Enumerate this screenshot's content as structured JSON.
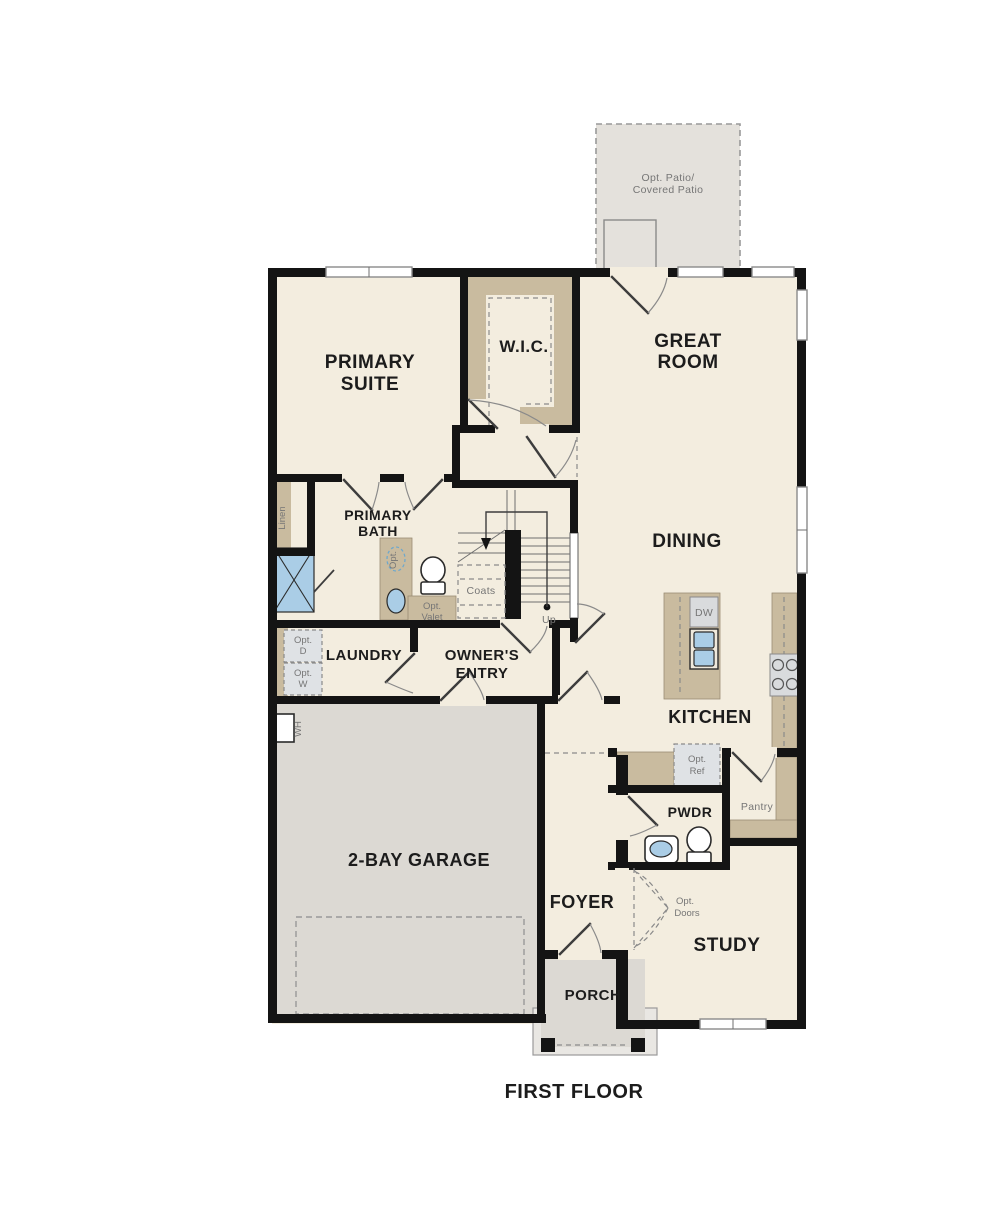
{
  "meta": {
    "title": "FIRST FLOOR",
    "plan_type": "single-family first floor plan"
  },
  "rooms": {
    "primary_suite": {
      "label_line1": "PRIMARY",
      "label_line2": "SUITE"
    },
    "wic": {
      "label": "W.I.C."
    },
    "great_room": {
      "label_line1": "GREAT",
      "label_line2": "ROOM"
    },
    "dining": {
      "label": "DINING"
    },
    "primary_bath": {
      "label_line1": "PRIMARY",
      "label_line2": "BATH"
    },
    "laundry": {
      "label": "LAUNDRY"
    },
    "owners_entry": {
      "label_line1": "OWNER'S",
      "label_line2": "ENTRY"
    },
    "kitchen": {
      "label": "KITCHEN"
    },
    "garage": {
      "label": "2-BAY GARAGE"
    },
    "pwdr": {
      "label": "PWDR"
    },
    "pantry": {
      "label": "Pantry"
    },
    "foyer": {
      "label": "FOYER"
    },
    "study": {
      "label": "STUDY"
    },
    "porch": {
      "label": "PORCH"
    }
  },
  "annotations": {
    "opt_patio": {
      "line1": "Opt. Patio/",
      "line2": "Covered Patio"
    },
    "linen": "Linen",
    "coats": "Coats",
    "stairs_up": "Up",
    "opt_valet": {
      "line1": "Opt.",
      "line2": "Valet"
    },
    "opt_dryer": {
      "line1": "Opt.",
      "line2": "D"
    },
    "opt_washer": {
      "line1": "Opt.",
      "line2": "W"
    },
    "water_heater": "WH",
    "dishwasher": "DW",
    "opt_ref": {
      "line1": "Opt.",
      "line2": "Ref"
    },
    "opt_doors": {
      "line1": "Opt.",
      "line2": "Doors"
    },
    "opt_sink": "Opt."
  },
  "colors": {
    "wall": "#141414",
    "floor": "#f3eddf",
    "garage_floor": "#dcd9d3",
    "patio_fill": "#e4e1dc",
    "cabinet_tan": "#c9bb9f",
    "fixture_blue": "#aacde6",
    "appliance_gray": "#d9dbdd",
    "label_dark": "#1c1c1c",
    "label_gray": "#767676"
  }
}
